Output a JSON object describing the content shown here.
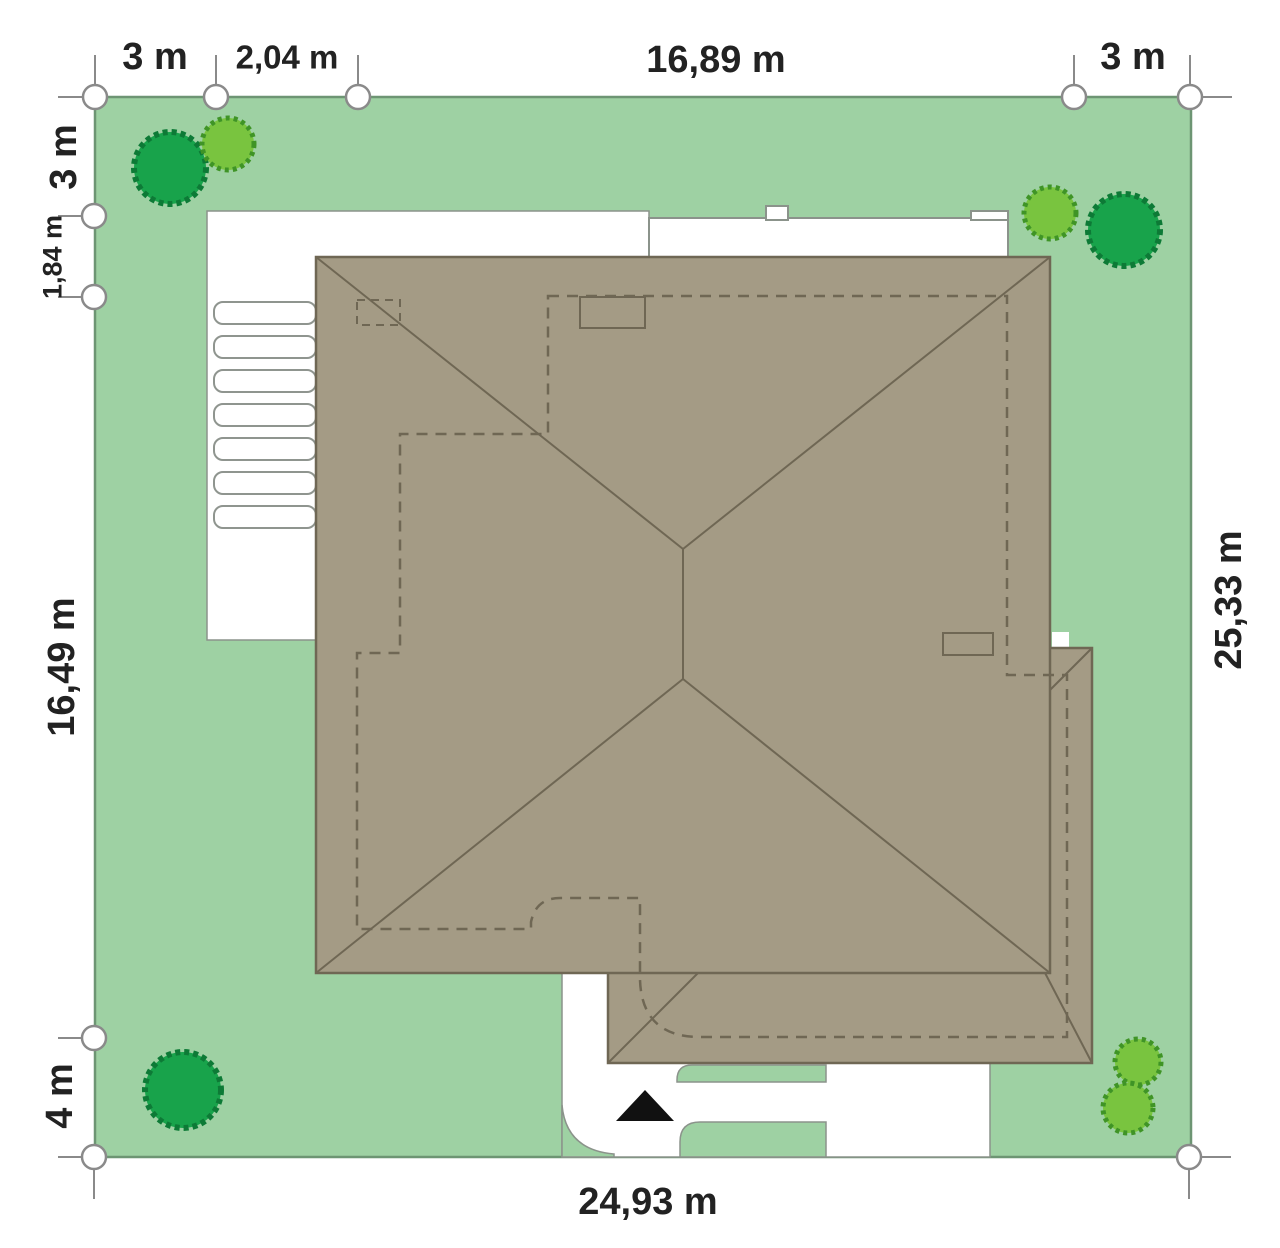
{
  "diagram": {
    "type": "site-plan",
    "dims": {
      "top_left_3m": "3 m",
      "top_204": "2,04 m",
      "top_1689": "16,89 m",
      "top_right_3m": "3 m",
      "left_3m": "3 m",
      "left_184": "1,84 m",
      "left_1649": "16,49 m",
      "left_4m": "4 m",
      "right_2533": "25,33 m",
      "bottom_2493": "24,93 m"
    },
    "colors": {
      "lawn": "#9ed1a3",
      "plot_border": "#6d9573",
      "roof": "#a49b85",
      "roof_line": "#6f6754",
      "paving": "#ffffff",
      "paving_line": "#8b938b",
      "tree_dark": "#18a34b",
      "tree_dark_line": "#0d7a36",
      "tree_light": "#79c43f",
      "tree_light_line": "#3f9426",
      "marker": "#111111",
      "text": "#222222"
    },
    "landscape": {
      "trees": [
        {
          "icon": "tree-icon",
          "corner": "top-left",
          "type": "dark"
        },
        {
          "icon": "tree-icon",
          "corner": "top-left",
          "type": "light"
        },
        {
          "icon": "tree-icon",
          "corner": "top-right",
          "type": "light"
        },
        {
          "icon": "tree-icon",
          "corner": "top-right",
          "type": "dark"
        },
        {
          "icon": "tree-icon",
          "corner": "bottom-left",
          "type": "dark"
        },
        {
          "icon": "tree-icon",
          "corner": "bottom-right",
          "type": "light"
        },
        {
          "icon": "tree-icon",
          "corner": "bottom-right",
          "type": "light"
        }
      ],
      "entrance_marker": "north-triangle"
    }
  }
}
